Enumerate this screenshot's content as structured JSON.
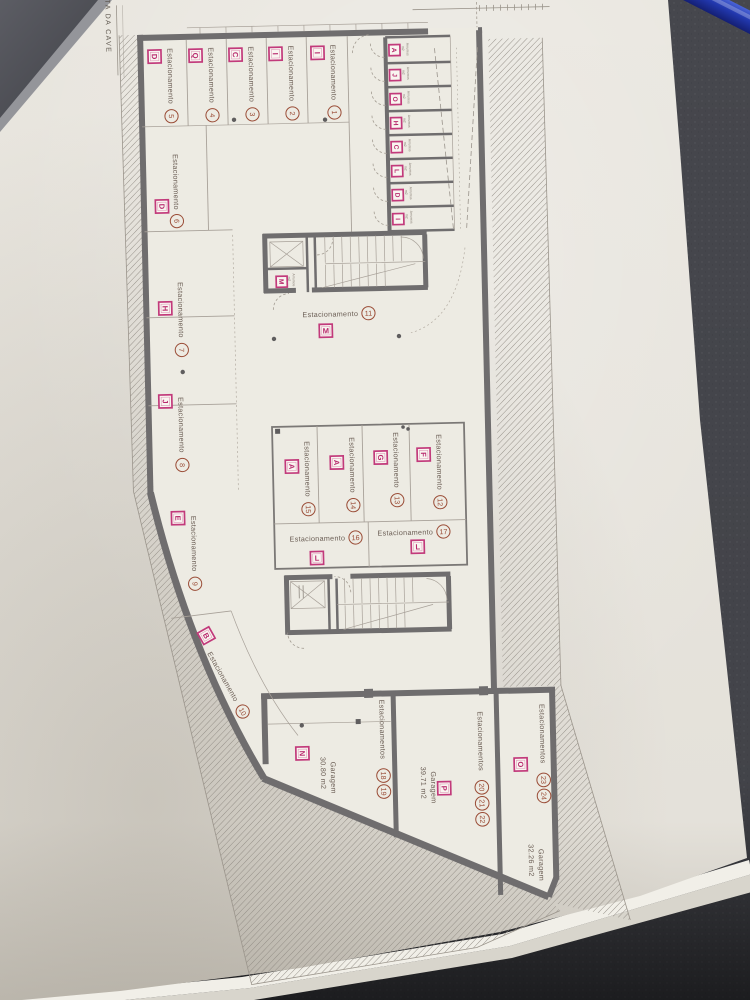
{
  "sheet": {
    "title": "PLANTA DA CAVE"
  },
  "legend_words": {
    "stall": "Estacionamento",
    "stalls_plural": "Estacionamentos",
    "garage": "Garagem",
    "storage": "Arrumos",
    "area_unit": "m2"
  },
  "stalls": [
    {
      "num": "1",
      "letter": "I"
    },
    {
      "num": "2",
      "letter": "I"
    },
    {
      "num": "3",
      "letter": "C"
    },
    {
      "num": "4",
      "letter": "Q"
    },
    {
      "num": "5",
      "letter": "D"
    },
    {
      "num": "6",
      "letter": "D"
    },
    {
      "num": "7",
      "letter": "H"
    },
    {
      "num": "8",
      "letter": "J"
    },
    {
      "num": "9",
      "letter": "E"
    },
    {
      "num": "10",
      "letter": "B"
    },
    {
      "num": "11",
      "letter": "M"
    },
    {
      "num": "12",
      "letter": "F"
    },
    {
      "num": "13",
      "letter": "G"
    },
    {
      "num": "14",
      "letter": "A"
    },
    {
      "num": "15",
      "letter": "A"
    },
    {
      "num": "16",
      "letter": "L"
    },
    {
      "num": "17",
      "letter": "L"
    }
  ],
  "garages": [
    {
      "nums": [
        "18",
        "19"
      ],
      "letter": "N",
      "area": "30.80 m2"
    },
    {
      "nums": [
        "20",
        "21",
        "22"
      ],
      "letter": "P",
      "area": "39.71 m2"
    },
    {
      "nums": [
        "23",
        "24"
      ],
      "letter": "O",
      "area": "32.26 m2"
    }
  ],
  "storage_rooms": {
    "letters": [
      "A",
      "J",
      "O",
      "H",
      "C",
      "L",
      "D",
      "I"
    ],
    "annex_letter": "M"
  },
  "colors": {
    "accent_magenta": "#c23a7b",
    "number_brown": "#9a4c36",
    "wall_gray": "#6f6d6e",
    "paper": "#e9e6df",
    "desk": "#46474d",
    "pen_blue": "#2b3fb0"
  }
}
